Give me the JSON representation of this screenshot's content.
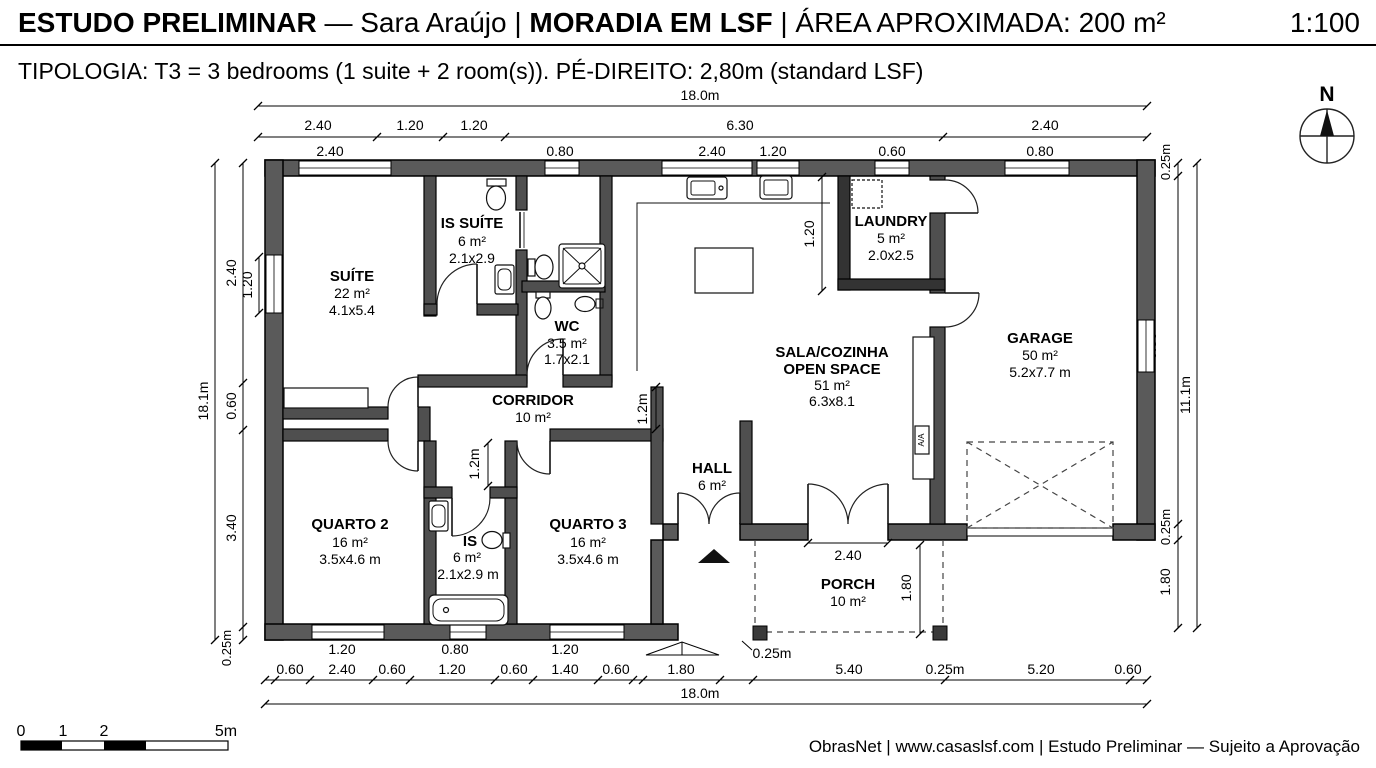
{
  "header": {
    "title_part1": "ESTUDO PRELIMINAR",
    "title_part2": " — Sara Araújo | ",
    "title_part3": "MORADIA EM LSF",
    "title_part4": " | ÁREA APROXIMADA: 200 m²",
    "scale_ratio": "1:100",
    "subtitle": "TIPOLOGIA: T3 = 3 bedrooms (1 suite + 2 room(s)). PÉ-DIREITO: 2,80m (standard LSF)"
  },
  "rooms": {
    "suite": {
      "name": "SUÍTE",
      "area": "22 m²",
      "size": "4.1x5.4"
    },
    "is_suite": {
      "name": "IS SUÍTE",
      "area": "6 m²",
      "size": "2.1x2.9"
    },
    "wc": {
      "name": "WC",
      "area": "3.5 m²",
      "size": "1.7x2.1"
    },
    "corridor": {
      "name": "CORRIDOR",
      "area": "10 m²"
    },
    "quarto2": {
      "name": "QUARTO 2",
      "area": "16 m²",
      "size": "3.5x4.6 m"
    },
    "is": {
      "name": "IS",
      "area": "6 m²",
      "size": "2.1x2.9 m"
    },
    "quarto3": {
      "name": "QUARTO 3",
      "area": "16 m²",
      "size": "3.5x4.6 m"
    },
    "hall": {
      "name": "HALL",
      "area": "6 m²"
    },
    "sala": {
      "name_line1": "SALA/COZINHA",
      "name_line2": "OPEN SPACE",
      "area": "51 m²",
      "size": "6.3x8.1"
    },
    "laundry": {
      "name": "LAUNDRY",
      "area": "5 m²",
      "size": "2.0x2.5"
    },
    "garage": {
      "name": "GARAGE",
      "area": "50 m²",
      "size": "5.2x7.7 m"
    },
    "porch": {
      "name": "PORCH",
      "area": "10 m²"
    }
  },
  "dims": {
    "top": {
      "overall": "18.0m",
      "row2": [
        "2.40",
        "1.20",
        "1.20",
        "6.30",
        "2.40"
      ],
      "row3": [
        "2.40",
        "0.80",
        "2.40",
        "1.20",
        "0.60",
        "0.80"
      ]
    },
    "left": {
      "overall": "18.1m",
      "segs": [
        "2.40",
        "0.60",
        "3.40",
        "0.25m"
      ],
      "window": "1.20"
    },
    "right": {
      "overall": "11.1m",
      "wall_top": "0.25m",
      "window": "0.80",
      "wall_bottom": "0.25m",
      "porch": "1.80"
    },
    "bottom": {
      "overall": "18.0m",
      "row_windows": [
        "1.20",
        "0.80",
        "1.20",
        "0.25m"
      ],
      "row_segs": [
        "0.60",
        "2.40",
        "0.60",
        "1.20",
        "0.60",
        "1.40",
        "0.60",
        "1.80",
        "5.40",
        "0.25m",
        "5.20",
        "0.60"
      ]
    },
    "inner": {
      "laundry_wall": "1.20",
      "corridor_width": "1.2m",
      "passage_width": "1.2m",
      "sala_door": "2.40",
      "porch_depth": "1.80"
    }
  },
  "compass": {
    "north": "N"
  },
  "scalebar": {
    "ticks": [
      "0",
      "1",
      "2",
      "5m"
    ]
  },
  "misc": {
    "ac_unit": "A/A"
  },
  "footer": {
    "text": "ObrasNet | www.casaslsf.com | Estudo Preliminar — Sujeito a Aprovação"
  }
}
